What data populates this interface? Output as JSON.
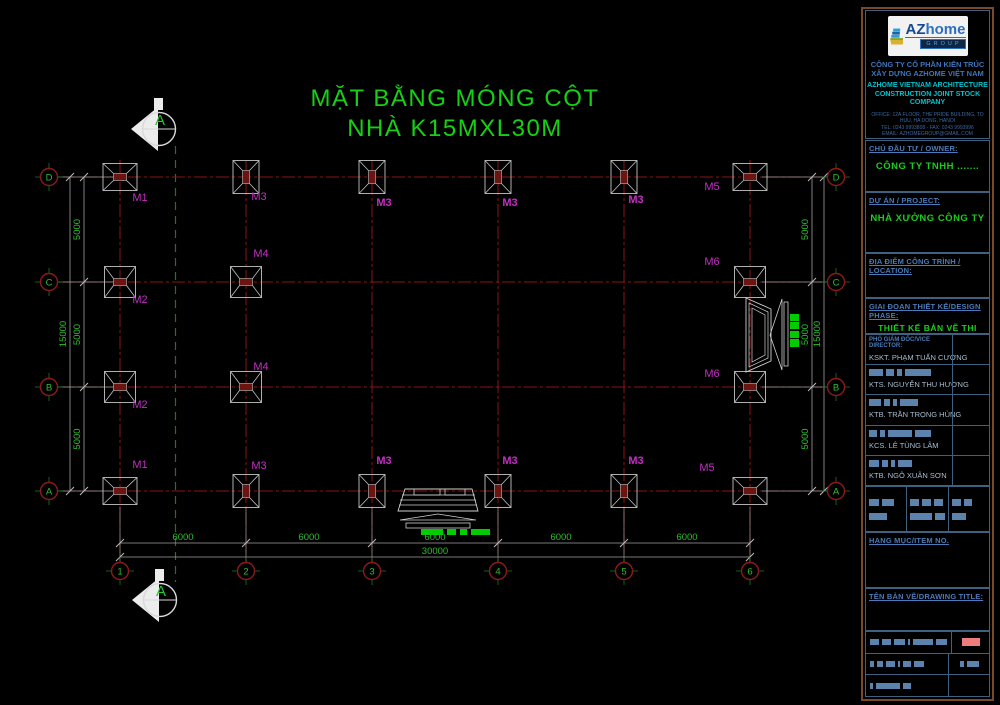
{
  "title": {
    "line1": "MẶT BẰNG MÓNG CỘT",
    "line2": "NHÀ K15MXL30M"
  },
  "colors": {
    "background": "#000000",
    "title_green": "#15d015",
    "dim_green": "#2fbb2f",
    "centerline_red": "#8a1515",
    "bubble_red": "#8c1a1a",
    "footing_gray": "#c2c2c2",
    "footing_pad_red": "#6b1410",
    "label_magenta": "#c42fc4",
    "section_green": "#1b7a1b",
    "marker_white": "#ececec",
    "green_marks": "#00cc00",
    "panel_border_brown": "#7a4a28",
    "panel_cell_blue": "#3f607e",
    "heading_blue": "#4a7ab8",
    "value_green": "#1ecb1e",
    "redact_blue": "#5b83ad",
    "stamp_red": "#ed7d7d"
  },
  "plan": {
    "section_label": "A",
    "grid_rows": [
      {
        "label": "D",
        "y": 177
      },
      {
        "label": "C",
        "y": 282
      },
      {
        "label": "B",
        "y": 387
      },
      {
        "label": "A",
        "y": 491
      }
    ],
    "grid_cols": [
      {
        "label": "1",
        "x": 120
      },
      {
        "label": "2",
        "x": 246
      },
      {
        "label": "3",
        "x": 372
      },
      {
        "label": "4",
        "x": 498
      },
      {
        "label": "5",
        "x": 624
      },
      {
        "label": "6",
        "x": 750
      }
    ],
    "dim_left_segments": [
      "5000",
      "5000",
      "5000"
    ],
    "dim_left_total": "15000",
    "dim_right_segments": [
      "5000",
      "5000",
      "5000"
    ],
    "dim_right_total": "15000",
    "dim_bottom_segments": [
      "6000",
      "6000",
      "6000",
      "6000",
      "6000"
    ],
    "dim_bottom_total": "30000",
    "footings": [
      {
        "row": "D",
        "col": 1,
        "type": "corner",
        "label": "M1",
        "lx": 140,
        "ly": 201,
        "bold": false
      },
      {
        "row": "D",
        "col": 2,
        "type": "edge",
        "label": "M3",
        "lx": 259,
        "ly": 200,
        "bold": false
      },
      {
        "row": "D",
        "col": 3,
        "type": "edge",
        "label": "M3",
        "lx": 384,
        "ly": 206,
        "bold": true
      },
      {
        "row": "D",
        "col": 4,
        "type": "edge",
        "label": "M3",
        "lx": 510,
        "ly": 206,
        "bold": true
      },
      {
        "row": "D",
        "col": 5,
        "type": "edge",
        "label": "M3",
        "lx": 636,
        "ly": 203,
        "bold": true
      },
      {
        "row": "D",
        "col": 6,
        "type": "corner",
        "label": "M5",
        "lx": 712,
        "ly": 190,
        "bold": false
      },
      {
        "row": "C",
        "col": 1,
        "type": "square",
        "label": "M2",
        "lx": 140,
        "ly": 303,
        "bold": false
      },
      {
        "row": "C",
        "col": 2,
        "type": "square",
        "label": "M4",
        "lx": 261,
        "ly": 257,
        "bold": false
      },
      {
        "row": "C",
        "col": 6,
        "type": "square",
        "label": "M6",
        "lx": 712,
        "ly": 265,
        "bold": false
      },
      {
        "row": "B",
        "col": 1,
        "type": "square",
        "label": "M2",
        "lx": 140,
        "ly": 408,
        "bold": false
      },
      {
        "row": "B",
        "col": 2,
        "type": "square",
        "label": "M4",
        "lx": 261,
        "ly": 370,
        "bold": false
      },
      {
        "row": "B",
        "col": 6,
        "type": "square",
        "label": "M6",
        "lx": 712,
        "ly": 377,
        "bold": false
      },
      {
        "row": "A",
        "col": 1,
        "type": "corner",
        "label": "M1",
        "lx": 140,
        "ly": 468,
        "bold": false
      },
      {
        "row": "A",
        "col": 2,
        "type": "edge",
        "label": "M3",
        "lx": 259,
        "ly": 469,
        "bold": false
      },
      {
        "row": "A",
        "col": 3,
        "type": "edge",
        "label": "M3",
        "lx": 384,
        "ly": 464,
        "bold": true
      },
      {
        "row": "A",
        "col": 4,
        "type": "edge",
        "label": "M3",
        "lx": 510,
        "ly": 464,
        "bold": true
      },
      {
        "row": "A",
        "col": 5,
        "type": "edge",
        "label": "M3",
        "lx": 636,
        "ly": 464,
        "bold": true
      },
      {
        "row": "A",
        "col": 6,
        "type": "corner",
        "label": "M5",
        "lx": 707,
        "ly": 471,
        "bold": false
      }
    ]
  },
  "title_block": {
    "logo": {
      "az": "AZ",
      "home": "home",
      "group": "GROUP"
    },
    "company_line1": "CÔNG TY CỔ PHẦN KIẾN TRÚC",
    "company_line2": "XÂY DỰNG AZHOME VIỆT NAM",
    "company_en_line1": "AZHOME VIETNAM ARCHITECTURE",
    "company_en_line2": "CONSTRUCTION JOINT STOCK COMPANY",
    "office": "OFFICE: 12A FLOOR, THE PRIDE BUILDING, TO HUU, HA DONG, HANOI",
    "tel": "TEL: 0243 9993808 - FAX: 0243 9993996",
    "email": "EMAIL: AZHOMEGROUP@GMAIL.COM",
    "website": "WEBSITE: AZHOMEGROUP.VN",
    "owner_label": "CHỦ ĐẦU TƯ / OWNER:",
    "owner_value": "CÔNG TY TNHH .......",
    "project_label": "DỰ ÁN / PROJECT:",
    "project_value": "NHÀ XƯỞNG CÔNG TY",
    "location_label": "ĐỊA ĐIỂM CÔNG TRÌNH / LOCATION:",
    "phase_label": "GIAI ĐOẠN THIẾT KẾ/DESIGN PHASE:",
    "phase_value": "THIẾT KẾ BẢN VẼ THI CÔNG",
    "signatories": [
      {
        "role": "PHÓ GIÁM ĐỐC/VICE DIRECTOR:",
        "name": "KSKT. PHẠM TUẤN CƯỜNG"
      },
      {
        "role": "",
        "name": "KTS. NGUYỄN THU HƯƠNG"
      },
      {
        "role": "",
        "name": "KTB. TRẦN TRỌNG HÙNG"
      },
      {
        "role": "",
        "name": "KCS. LÊ TÙNG LÂM"
      },
      {
        "role": "",
        "name": "KTB. NGÔ XUÂN SƠN"
      }
    ],
    "item_label": "HẠNG MỤC/ITEM NO.",
    "drawing_title_label": "TÊN BẢN VẼ/DRAWING TITLE:"
  }
}
